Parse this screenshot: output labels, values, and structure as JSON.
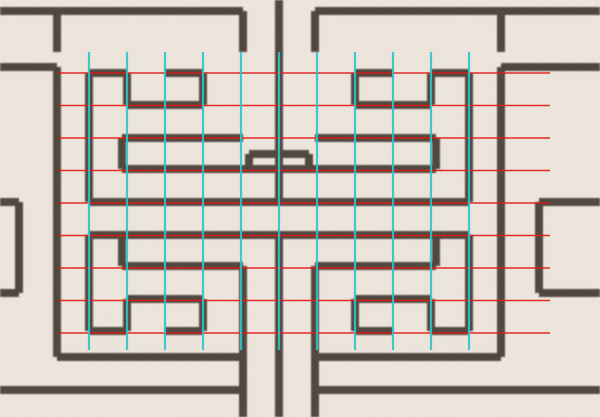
{
  "figure": {
    "kind": "lattice-pattern-with-construction-grid",
    "width": 600,
    "height": 417
  },
  "colors": {
    "background": "#f2ebe2",
    "lattice": "#4a4038",
    "grid_red": "#e01810",
    "grid_cyan": "#2fc4cb"
  },
  "lattice": {
    "stroke_width": 8,
    "strokes": [
      [
        0,
        11,
        243,
        11
      ],
      [
        315,
        11,
        600,
        11
      ],
      [
        243,
        11,
        243,
        52
      ],
      [
        315,
        11,
        315,
        52
      ],
      [
        279,
        0,
        279,
        202
      ],
      [
        279,
        235,
        279,
        417
      ],
      [
        57,
        11,
        57,
        52
      ],
      [
        0,
        67,
        57,
        67
      ],
      [
        57,
        67,
        57,
        357
      ],
      [
        0,
        202,
        19,
        202
      ],
      [
        19,
        202,
        19,
        293
      ],
      [
        0,
        293,
        19,
        293
      ],
      [
        501,
        11,
        501,
        52
      ],
      [
        501,
        67,
        600,
        67
      ],
      [
        501,
        67,
        501,
        357
      ],
      [
        539,
        202,
        600,
        202
      ],
      [
        539,
        202,
        539,
        293
      ],
      [
        539,
        293,
        600,
        293
      ],
      [
        122,
        169,
        436,
        169
      ],
      [
        89,
        202,
        469,
        202
      ],
      [
        89,
        235,
        469,
        235
      ],
      [
        89,
        73,
        89,
        202
      ],
      [
        89,
        73,
        127,
        73
      ],
      [
        127,
        73,
        127,
        105
      ],
      [
        127,
        105,
        203,
        105
      ],
      [
        203,
        73,
        203,
        105
      ],
      [
        165,
        73,
        203,
        73
      ],
      [
        122,
        138,
        243,
        138
      ],
      [
        122,
        138,
        122,
        169
      ],
      [
        249,
        154,
        279,
        154
      ],
      [
        249,
        154,
        249,
        169
      ],
      [
        469,
        73,
        469,
        202
      ],
      [
        431,
        73,
        469,
        73
      ],
      [
        431,
        73,
        431,
        105
      ],
      [
        355,
        105,
        431,
        105
      ],
      [
        355,
        73,
        355,
        105
      ],
      [
        355,
        73,
        393,
        73
      ],
      [
        315,
        138,
        436,
        138
      ],
      [
        436,
        138,
        436,
        169
      ],
      [
        279,
        154,
        309,
        154
      ],
      [
        309,
        154,
        309,
        169
      ],
      [
        89,
        235,
        89,
        331
      ],
      [
        89,
        331,
        127,
        331
      ],
      [
        127,
        299,
        127,
        331
      ],
      [
        127,
        299,
        203,
        299
      ],
      [
        203,
        299,
        203,
        331
      ],
      [
        165,
        331,
        203,
        331
      ],
      [
        122,
        235,
        122,
        266
      ],
      [
        122,
        266,
        243,
        266
      ],
      [
        469,
        235,
        469,
        331
      ],
      [
        431,
        331,
        469,
        331
      ],
      [
        431,
        299,
        431,
        331
      ],
      [
        355,
        299,
        431,
        299
      ],
      [
        355,
        299,
        355,
        331
      ],
      [
        355,
        331,
        393,
        331
      ],
      [
        436,
        235,
        436,
        266
      ],
      [
        315,
        266,
        436,
        266
      ],
      [
        243,
        266,
        243,
        417
      ],
      [
        315,
        266,
        315,
        417
      ],
      [
        57,
        357,
        243,
        357
      ],
      [
        315,
        357,
        501,
        357
      ],
      [
        0,
        390,
        243,
        390
      ],
      [
        315,
        390,
        600,
        390
      ]
    ]
  },
  "grid": {
    "red_rows": {
      "y": [
        73,
        105.5,
        138,
        170.5,
        203,
        235.5,
        268,
        300.5,
        333
      ],
      "x_start": 58,
      "x_end": 550,
      "stroke_width": 1.6
    },
    "cyan_cols": {
      "x": [
        89,
        127,
        165,
        203,
        241,
        279,
        317,
        355,
        393,
        431,
        469
      ],
      "y_start": 52,
      "y_end": 350,
      "stroke_width": 2.2
    }
  }
}
